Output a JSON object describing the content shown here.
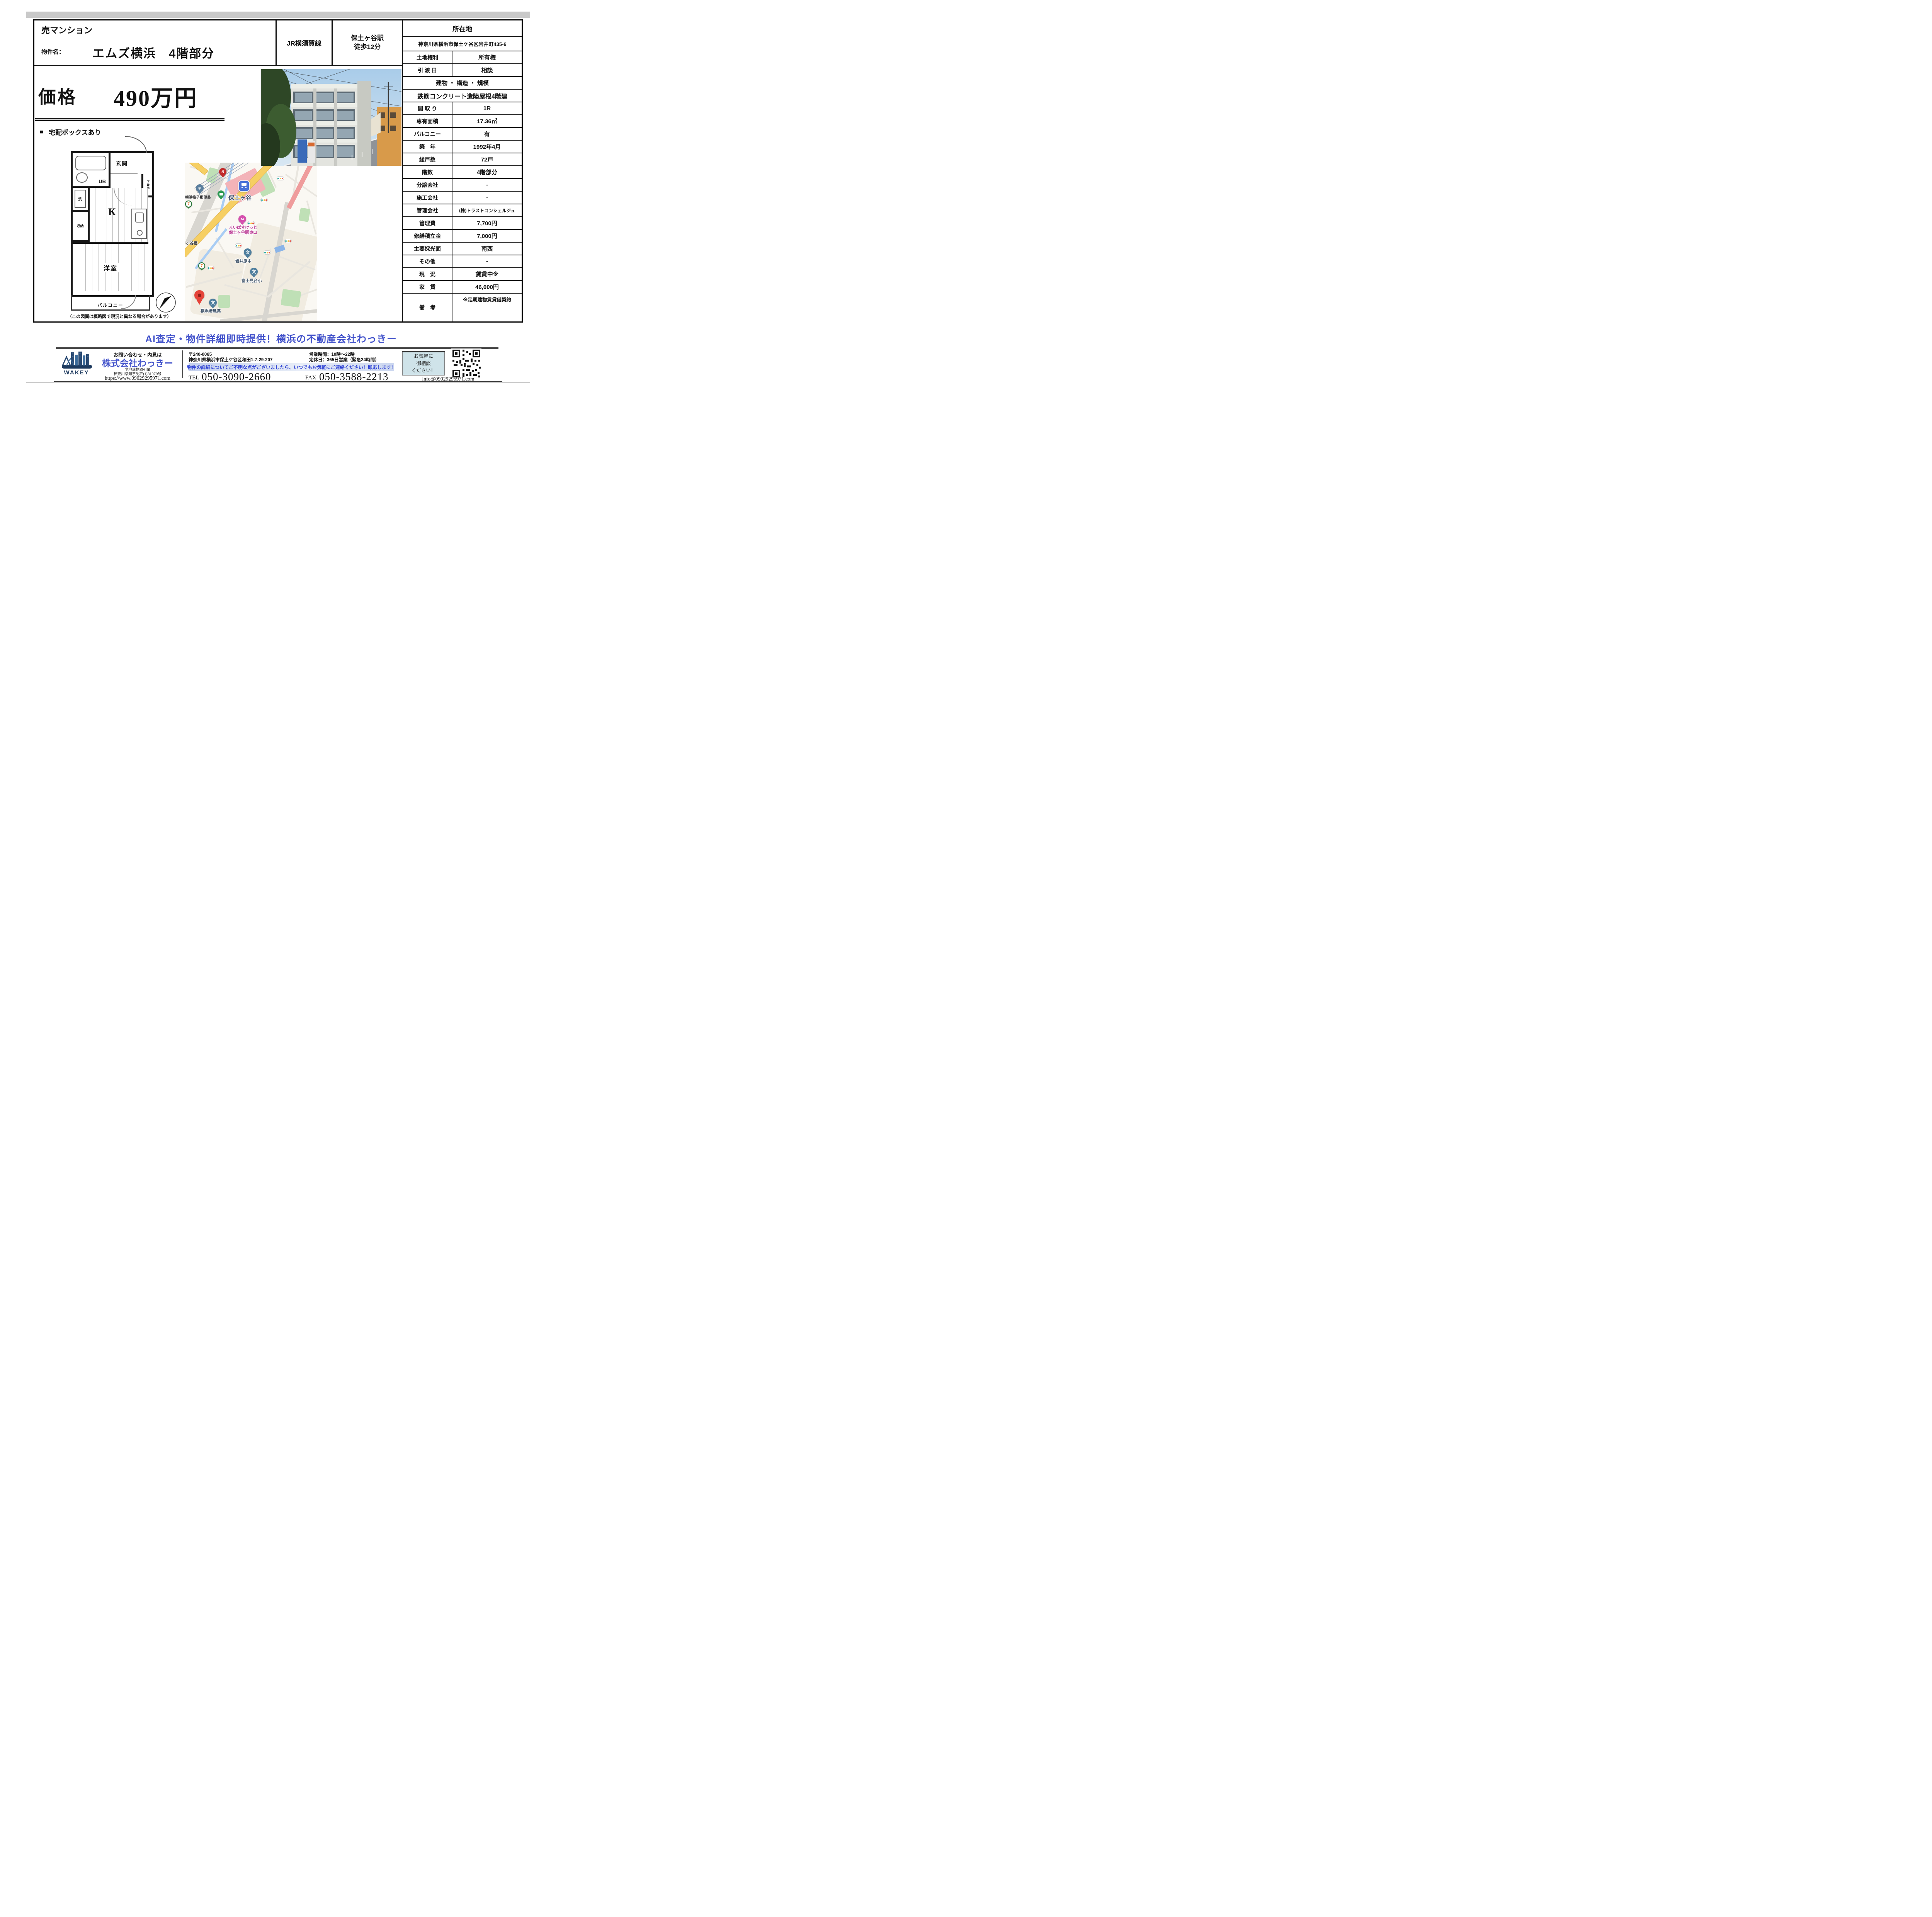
{
  "header": {
    "property_type": "売マンション",
    "name_label": "物件名：",
    "property_name": "エムズ横浜　4階部分",
    "rail_line": "JR横須賀線",
    "station_line1": "保土ヶ谷駅",
    "station_line2": "徒歩12分"
  },
  "price": {
    "label": "価格",
    "value": "490万円"
  },
  "feature": {
    "bullet": "■",
    "text": "宅配ボックスあり"
  },
  "floorplan": {
    "genkan": "玄関",
    "ub": "UB",
    "getabako": "下駄箱",
    "laundry": "洗",
    "kitchen": "K",
    "storage": "収納",
    "room": "洋室",
    "balcony": "バルコニー",
    "caption": "（この図面は概略図で現況と異なる場合があります）"
  },
  "map": {
    "station": "保土ヶ谷",
    "post_office": "横浜帷子郵便局",
    "gusto": "ガ",
    "seven": "7",
    "maibasuketto_pin": "24",
    "maibasuketto_1": "まいばすけっと",
    "maibasuketto_2": "保土ヶ谷駅東口",
    "junior_high": "岩井原中",
    "elementary": "富士見台小",
    "high_school": "横浜清風高",
    "bridge": "ヶ谷橋",
    "school_glyph": "文",
    "post_glyph": "〒"
  },
  "details": {
    "location_header": "所在地",
    "address": "神奈川県横浜市保土ケ谷区岩井町435-6",
    "land_rows": [
      {
        "label": "土地権利",
        "value": "所有権"
      },
      {
        "label": "引 渡 日",
        "value": "相談"
      }
    ],
    "building_header": "建物 ・ 構造 ・ 規模",
    "building_value": "鉄筋コンクリート造陸屋根4階建",
    "rows": [
      {
        "label": "間 取 り",
        "value": "1R"
      },
      {
        "label": "専有面積",
        "value": "17.36㎡"
      },
      {
        "label": "バルコニー",
        "value": "有"
      },
      {
        "label": "築　年",
        "value": "1992年4月"
      },
      {
        "label": "総戸数",
        "value": "72戸"
      },
      {
        "label": "階数",
        "value": "4階部分"
      },
      {
        "label": "分譲会社",
        "value": "-"
      },
      {
        "label": "施工会社",
        "value": "-"
      },
      {
        "label": "管理会社",
        "value": "(株)トラストコンシェルジュ"
      },
      {
        "label": "管理費",
        "value": "7,700円"
      },
      {
        "label": "修繕積立金",
        "value": "7,000円"
      },
      {
        "label": "主要採光面",
        "value": "南西"
      },
      {
        "label": "その他",
        "value": "-"
      },
      {
        "label": "現　況",
        "value": "賃貸中※"
      },
      {
        "label": "家　賃",
        "value": "46,000円"
      }
    ],
    "remarks": {
      "label": "備　考",
      "value": "※定期建物賃貸借契約"
    }
  },
  "banner": "AI査定・物件詳細即時提供！横浜の不動産会社わっきー",
  "footer": {
    "contact_lead": "お問い合わせ・内見は",
    "company": "株式会社わっきー",
    "license_type": "宅地建物取引業",
    "license_no": "神奈川県知事免許(1)31979号",
    "url": "https://www.09029295971.com",
    "logo_text": "WAKEY",
    "postal": "〒240-0065",
    "office_address": "神奈川県横浜市保土ケ谷区和田1-7-29-207",
    "hours": "営業時間：10時～22時",
    "holiday": "定休日：365日営業（緊急24時間）",
    "notice": "物件の詳細についてご不明な点がございましたら、いつでもお気軽にご連絡ください！即応します！",
    "tel_label": "TEL",
    "tel": "050-3090-2660",
    "fax_label": "FAX",
    "fax": "050-3588-2213",
    "consult_1": "お気軽に",
    "consult_2": "御相談",
    "consult_3": "ください！",
    "email": "info@09029295971.com"
  },
  "colors": {
    "accent_blue": "#4353cb",
    "notice_blue": "#2b3fd4",
    "maibasuketto_pink": "#bb3d96",
    "map_yellow_road": "#f6cf63",
    "table_border": "#111111"
  }
}
